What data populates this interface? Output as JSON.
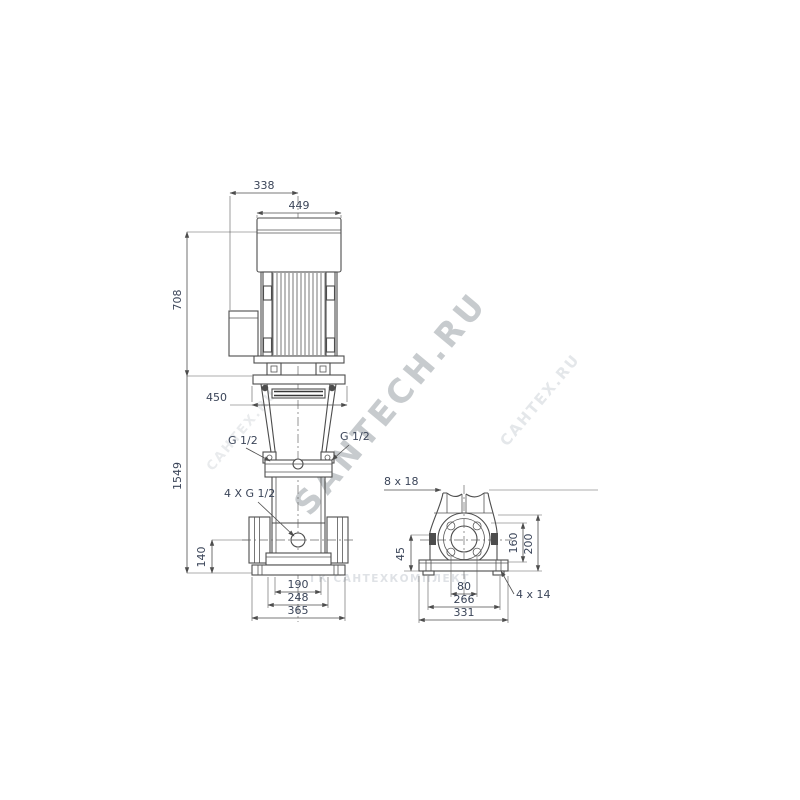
{
  "watermarks": {
    "brand_large": "SANTECH.RU",
    "brand_small": "САНТЕХ.RU",
    "company": "ГК САНТЕХКОМПЛЕКТ"
  },
  "front_view": {
    "width_terminal_to_center": "338",
    "motor_width": "449",
    "motor_height": "708",
    "clearance_width": "450",
    "total_height": "1549",
    "port_center_height": "140",
    "gauge_port_left": "G 1/2",
    "gauge_port_right": "G 1/2",
    "drain_port": "4 X G 1/2",
    "base_bolt_spacing": "190",
    "base_mid_width": "248",
    "base_width": "365"
  },
  "side_view": {
    "slot_size": "8 x 18",
    "foot_offset": "45",
    "port_height": "160",
    "flange_top_height": "200",
    "bolt_spacing": "80",
    "base_bolt_spacing": "266",
    "base_width": "331",
    "base_holes": "4 x 14"
  }
}
